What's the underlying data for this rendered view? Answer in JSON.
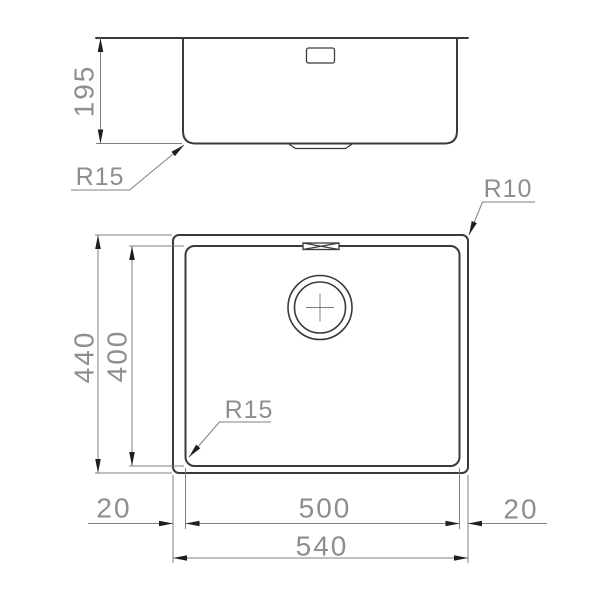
{
  "colors": {
    "outline": "#3a3a3a",
    "dimension": "#808080",
    "text": "#8e8e8e",
    "arrow": "#1f1f1f",
    "background": "#ffffff"
  },
  "side_view": {
    "depth": "195",
    "corner_radius": "R15"
  },
  "plan_view": {
    "corner_radius_outer": "R10",
    "corner_radius_inner": "R15",
    "overall_height": "440",
    "bowl_height": "400",
    "left_offset": "20",
    "bowl_width": "500",
    "right_offset": "20",
    "overall_width": "540"
  }
}
